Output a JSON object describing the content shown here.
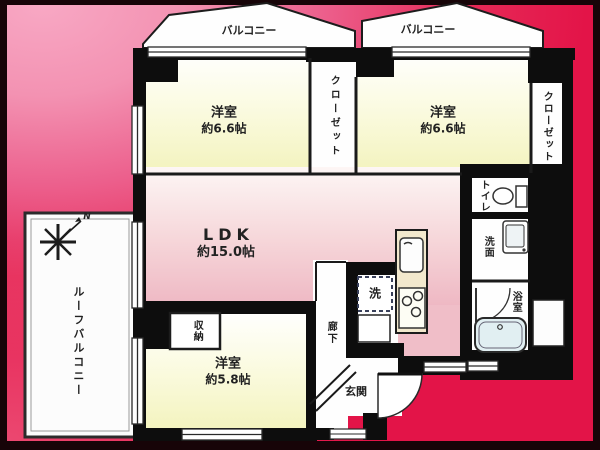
{
  "plan": {
    "balcony_left": "バルコニー",
    "balcony_right": "バルコニー",
    "roof_balcony": "ルーフバルコニー",
    "compass": "N",
    "rooms": {
      "bedroom_top_left": {
        "name": "洋室",
        "size": "約6.6帖"
      },
      "bedroom_top_right": {
        "name": "洋室",
        "size": "約6.6帖"
      },
      "bedroom_bottom": {
        "name": "洋室",
        "size": "約5.8帖"
      },
      "ldk": {
        "name": "LDK",
        "size": "約15.0帖"
      },
      "closet_middle": "クローゼット",
      "closet_right": "クローゼット",
      "toilet": "トイレ",
      "washroom": "洗面",
      "bathroom": "浴室",
      "laundry": "洗",
      "hallway": "廊下",
      "entrance": "玄関",
      "storage": "収納"
    },
    "colors": {
      "background_pink": "#f8a8c4",
      "background_red": "#e31448",
      "frame_dark": "#170408",
      "wall_black": "#0d0d0d",
      "room_yellow": "#f5f5c5",
      "ldk_pink": "#efb9c4",
      "kitchen_counter_cream": "#f2e8cd",
      "bathtub_blue": "#e1eff2",
      "room_white": "#fefefe"
    }
  }
}
